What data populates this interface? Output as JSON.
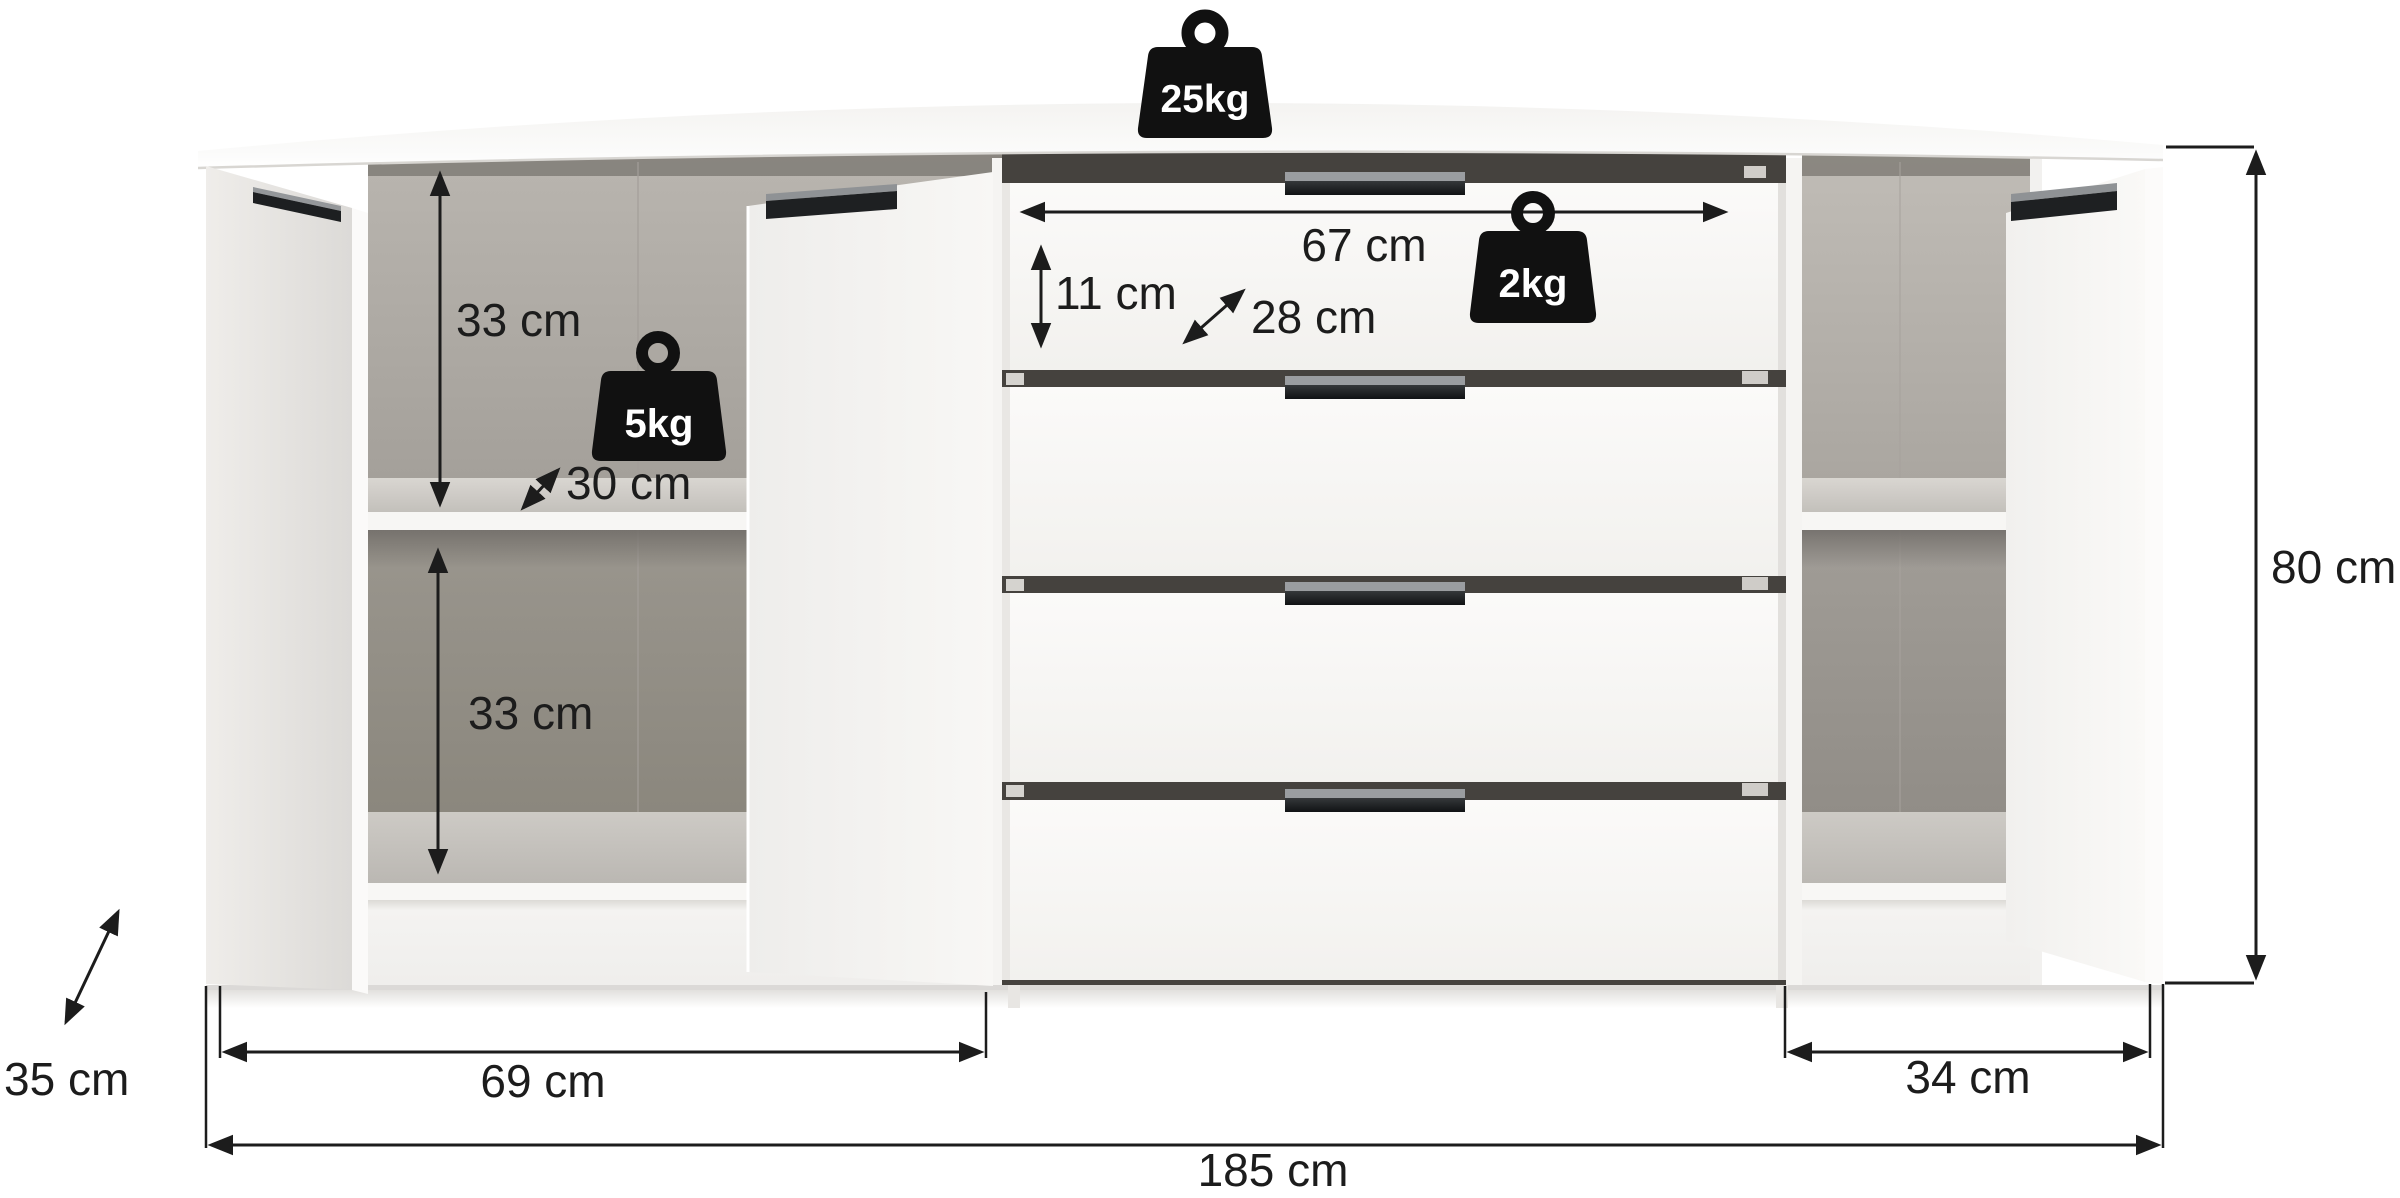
{
  "page": {
    "background_color": "#ffffff"
  },
  "diagram": {
    "kind": "furniture-dimension-diagram",
    "item": "sideboard with three doors and four drawers",
    "annotation_color": "#1c1c1c",
    "weight_icon_color": "#111111",
    "weight_label_color": "#ffffff",
    "weight_limits": [
      {
        "id": "top-panel-max-load",
        "label": "25kg"
      },
      {
        "id": "drawer-max-load",
        "label": "2kg"
      },
      {
        "id": "shelf-max-load",
        "label": "5kg"
      }
    ],
    "dimensions": {
      "drawer_inner_width": "67 cm",
      "drawer_inner_height": "11 cm",
      "drawer_inner_depth": "28 cm",
      "upper_compartment_height": "33 cm",
      "lower_compartment_height": "33 cm",
      "shelf_depth": "30 cm",
      "total_height": "80 cm",
      "total_depth": "35 cm",
      "left_section_width": "69 cm",
      "right_section_width": "34 cm",
      "total_width": "185 cm"
    }
  }
}
